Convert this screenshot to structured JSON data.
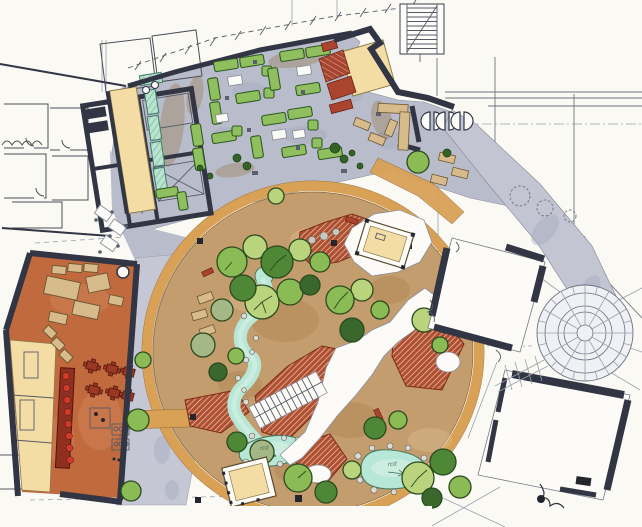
{
  "palette": {
    "paper": "#faf9f4",
    "wall_dark": "#2e3340",
    "marker": "#23262f",
    "plaza": "#b9bdcb",
    "walkway": "#c5c8d4",
    "road": "#c3c6d2",
    "blotch_gray": "#a6abbf",
    "stain_brown": "#9a7a52",
    "garden": "#c49d6e",
    "garden_dark": "#a87e4c",
    "garden_light": "#d9bd92",
    "ring": "#d9a156",
    "deck_red": "#b05030",
    "struct_red": "#a9442f",
    "water": "#b7e7d7",
    "water_light": "#d2efe3",
    "rock": "#dcdcd6",
    "tree_light": "#b9d47d",
    "tree_mid": "#8abb55",
    "tree_dark": "#4e8736",
    "tree_deep": "#39672c",
    "tree_sage": "#a3b886",
    "shrub": "#356327",
    "sofa_green": "#8fbf5f",
    "teal_bench": "#b9e4cf",
    "yellow": "#f3dda4",
    "furniture_tan": "#d8bb8b",
    "cafe_floor": "#c06a3e",
    "cafe_light": "#d08357",
    "dining_red": "#9c3722",
    "counter_red": "#8f2f1f",
    "dot_red": "#d03a2a",
    "white": "#fcfbf7",
    "radial_fill": "#f0f1f5"
  },
  "annotations": {
    "pond_a": {
      "text": "rcd"
    },
    "pond_b": {
      "text": "rcd"
    }
  },
  "regions": [
    "upper-plaza",
    "garden-court",
    "cafe-building",
    "gallery-core-building",
    "kiosk-canopy",
    "courtyard-building-east",
    "courtyard-building-southeast",
    "radial-plaza",
    "service-road",
    "stream-and-ponds",
    "boardwalk-decks",
    "ring-path",
    "west-walkway"
  ]
}
